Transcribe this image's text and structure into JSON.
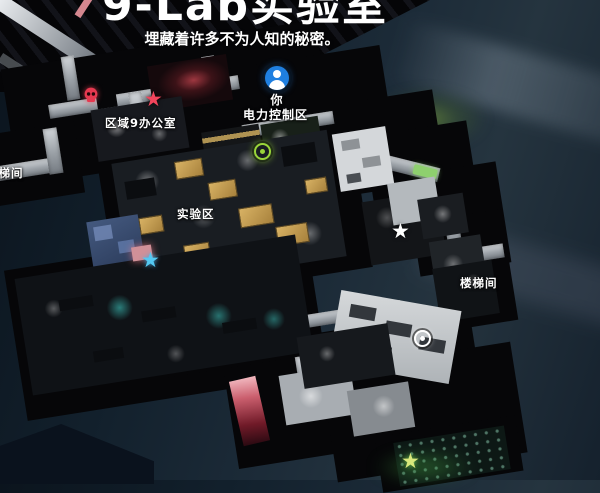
{
  "header": {
    "title": "9-Lab实验室",
    "subtitle": "埋藏着许多不为人知的秘密。"
  },
  "player": {
    "you_label": "你",
    "area_label": "电力控制区"
  },
  "area_labels": {
    "zone9_office": "区域9办公室",
    "lab_zone": "实验区",
    "stairwell_left": "楼梯间",
    "stairwell_right": "楼梯间"
  },
  "markers": {
    "player_icon": {
      "name": "player-location-icon",
      "color": "#1f7fe0"
    },
    "enemy_skull": {
      "name": "enemy-skull-icon",
      "color": "#e63950"
    },
    "star_red": {
      "glyph": "★",
      "color": "#f2455c"
    },
    "star_cyan": {
      "glyph": "★",
      "color": "#54c8f2"
    },
    "star_white": {
      "glyph": "★",
      "color": "#ffffff"
    },
    "star_green": {
      "glyph": "★",
      "color": "#d9e87c"
    },
    "waypoint_green": {
      "name": "waypoint-ring-green",
      "color": "#9ad53a"
    },
    "waypoint_white": {
      "name": "waypoint-ring-white",
      "color": "#ffffff"
    }
  },
  "colors": {
    "background": "#131f2b",
    "building": "#060608",
    "corridor": "#c9ced2",
    "lab_desk": "#d0aa5e",
    "alert_red": "#c45566",
    "glow_cyan": "#46e6dc",
    "glow_green": "#8ed06e",
    "room_blue": "#44597f"
  }
}
